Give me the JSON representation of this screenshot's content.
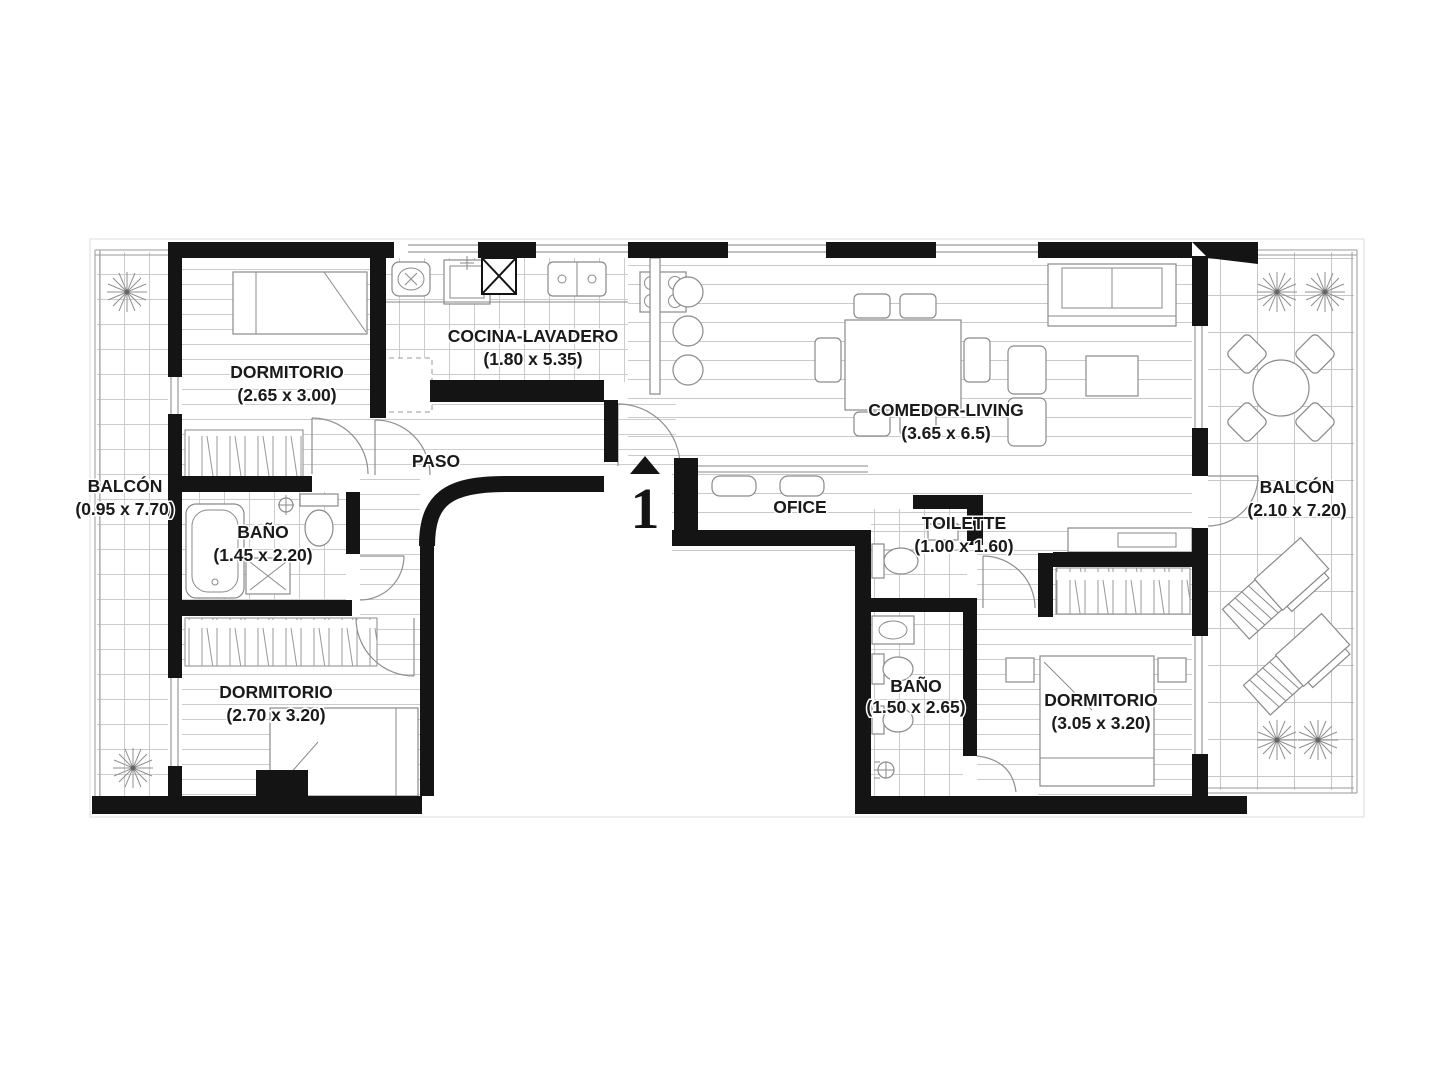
{
  "plan": {
    "unit_marker": "1",
    "rooms": [
      {
        "id": "dormitorio1",
        "name": "DORMITORIO",
        "dims": "(2.65 x 3.00)"
      },
      {
        "id": "cocina-lavadero",
        "name": "COCINA-LAVADERO",
        "dims": "(1.80 x 5.35)"
      },
      {
        "id": "comedor-living",
        "name": "COMEDOR-LIVING",
        "dims": "(3.65 x 6.5)"
      },
      {
        "id": "balcon-izquierdo",
        "name": "BALCÓN",
        "dims": "(0.95 x 7.70)"
      },
      {
        "id": "balcon-derecho",
        "name": "BALCÓN",
        "dims": "(2.10 x 7.20)"
      },
      {
        "id": "paso",
        "name": "PASO",
        "dims": ""
      },
      {
        "id": "bano1",
        "name": "BAÑO",
        "dims": "(1.45 x 2.20)"
      },
      {
        "id": "ofice",
        "name": "OFICE",
        "dims": ""
      },
      {
        "id": "toilette",
        "name": "TOILETTE",
        "dims": "(1.00 x 1.60)"
      },
      {
        "id": "dormitorio2",
        "name": "DORMITORIO",
        "dims": "(2.70 x 3.20)"
      },
      {
        "id": "bano2",
        "name": "BAÑO",
        "dims": "(1.50 x 2.65)"
      },
      {
        "id": "dormitorio3",
        "name": "DORMITORIO",
        "dims": "(3.05 x 3.20)"
      }
    ],
    "colors": {
      "wall": "#141414",
      "floor_line": "#cccccc",
      "furniture_line": "#8a8a8a",
      "label_text": "#1a1a1a",
      "background": "#ffffff"
    }
  }
}
